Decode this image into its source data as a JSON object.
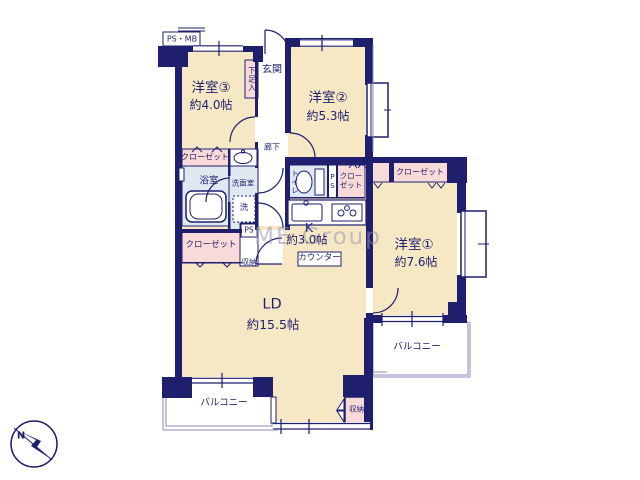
{
  "plan": {
    "watermark": "ME Group",
    "compass_n": "N",
    "shaft_label": "PS・MB",
    "rooms": {
      "room3": {
        "name": "洋室③",
        "size": "約4.0帖"
      },
      "room2": {
        "name": "洋室②",
        "size": "約5.3帖"
      },
      "room1": {
        "name": "洋室①",
        "size": "約7.6帖"
      },
      "ld": {
        "name": "LD",
        "size": "約15.5帖"
      },
      "kitchen": {
        "name": "K",
        "size": "約3.0帖"
      }
    },
    "labels": {
      "entrance": "玄関",
      "shoe_box": "下足入",
      "corridor": "廊下",
      "closet": "クローゼット",
      "bathroom": "浴室",
      "washroom": "洗面室",
      "laundry": "洗",
      "toilet": "トイレ",
      "pipe_space": "PS",
      "counter": "カウンター",
      "storage": "収納",
      "balcony": "バルコニー"
    },
    "colors": {
      "wall": "#1f1f6e",
      "floor": "#f7e8c5",
      "closet_fill": "#f8dbd8",
      "wet_fill": "#dfe9f2",
      "thin_line": "#8a8ac0"
    }
  }
}
